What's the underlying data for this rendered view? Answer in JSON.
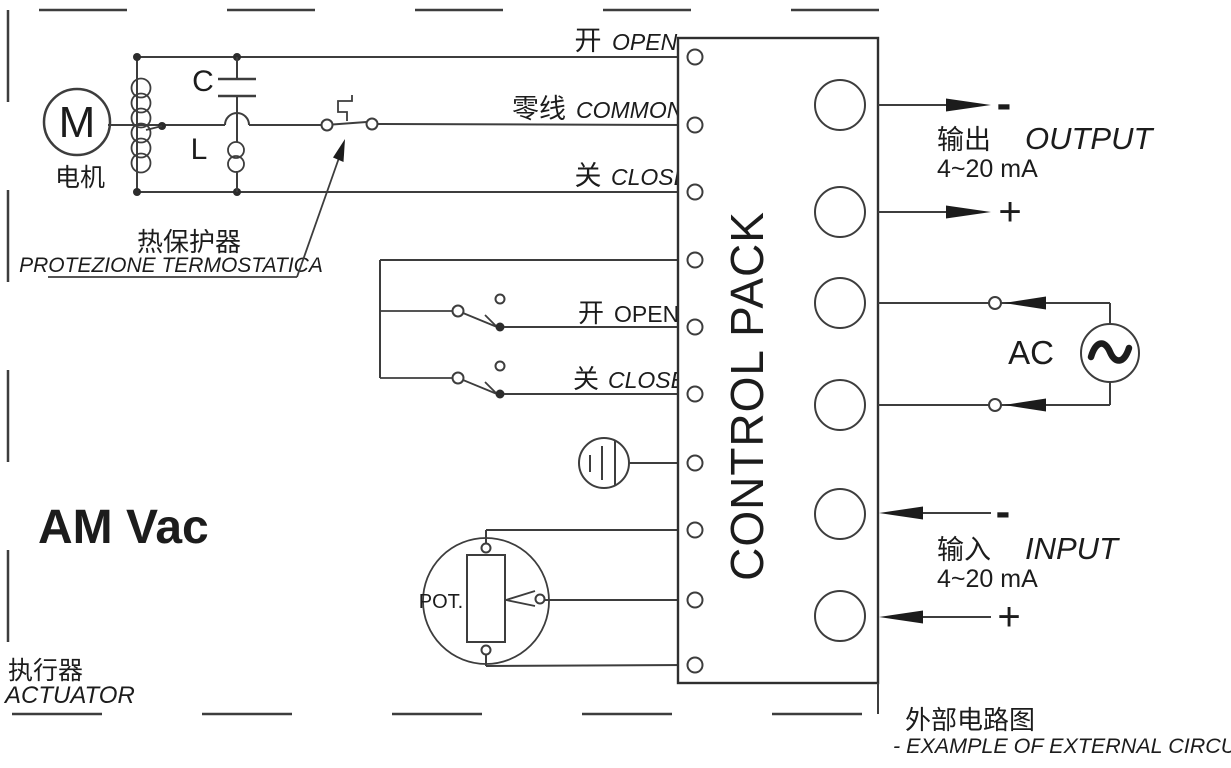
{
  "diagram": {
    "actuator": {
      "model": "AM Vac",
      "name_cn": "执行器",
      "name_en": "ACTUATOR",
      "motor": {
        "letter": "M",
        "label_cn": "电机"
      },
      "capacitor": "C",
      "inductor": "L",
      "thermal_protection": {
        "cn": "热保护器",
        "it": "PROTEZIONE TERMOSTATICA"
      },
      "power_wires": {
        "open_cn": "开",
        "open_en": "OPEN",
        "common_cn": "零线",
        "common_en": "COMMON",
        "close_cn": "关",
        "close_en": "CLOSE"
      },
      "limit_switches": {
        "open_cn": "开",
        "open_en": "OPEN",
        "close_cn": "关",
        "close_en": "CLOSE"
      },
      "potentiometer": "POT."
    },
    "control_pack": {
      "title": "CONTROL PACK"
    },
    "external_circuit": {
      "output": {
        "minus": "-",
        "plus": "+",
        "label_cn": "输出",
        "label_en": "OUTPUT",
        "range": "4~20 mA"
      },
      "ac_source": {
        "label": "AC"
      },
      "input": {
        "minus": "-",
        "plus": "+",
        "label_cn": "输入",
        "label_en": "INPUT",
        "range": "4~20 mA"
      },
      "caption_cn": "外部电路图",
      "caption_en": "- EXAMPLE OF EXTERNAL CIRCUIT -"
    },
    "colors": {
      "line": "#3d3d3d",
      "text": "#1c1c1c"
    }
  }
}
